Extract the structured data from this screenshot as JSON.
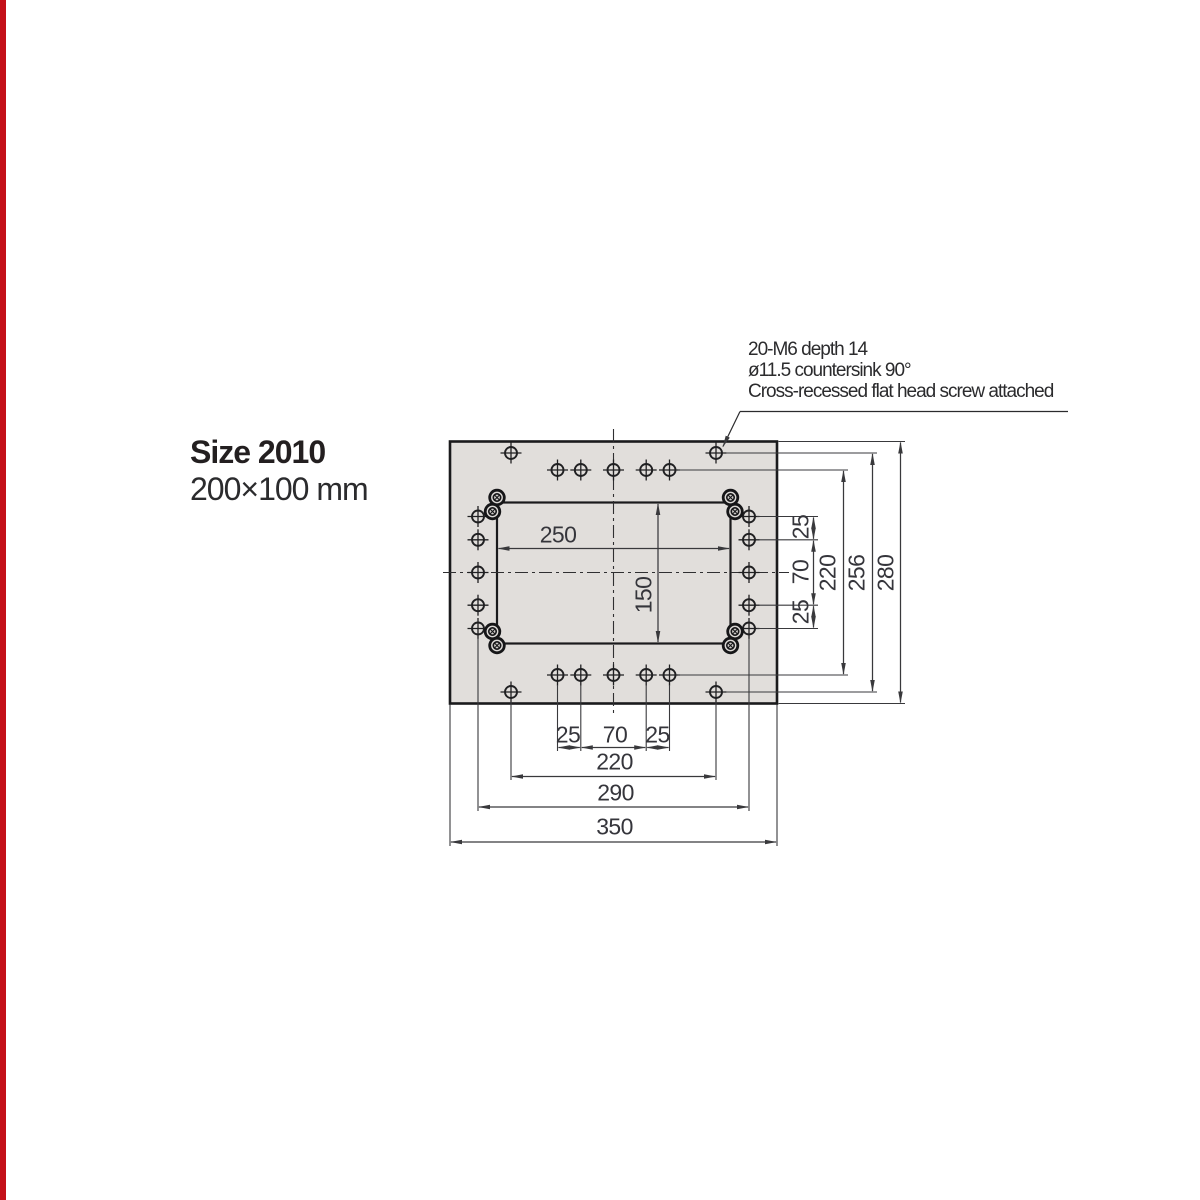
{
  "page": {
    "edge_bar_color": "#c41019",
    "background_color": "#ffffff"
  },
  "title": {
    "heading": "Size 2010",
    "subtitle": "200×100 mm"
  },
  "annotation": {
    "lines": [
      "20-M6 depth 14",
      "ø11.5 countersink 90°",
      "Cross-recessed flat head screw attached"
    ]
  },
  "drawing": {
    "plate_fill_color": "#e1dedb",
    "line_color": "#2c2c2e",
    "dims": {
      "opening_width": "250",
      "opening_height": "150",
      "right": {
        "pitch_top": "25",
        "pitch_mid": "70",
        "pitch_bottom": "25",
        "inner_rows": "220",
        "outer_holes": "256",
        "plate_height": "280"
      },
      "bottom": {
        "pitch_left": "25",
        "pitch_mid": "70",
        "pitch_right": "25",
        "outer_holes": "220",
        "side_columns": "290",
        "plate_width": "350"
      }
    }
  }
}
